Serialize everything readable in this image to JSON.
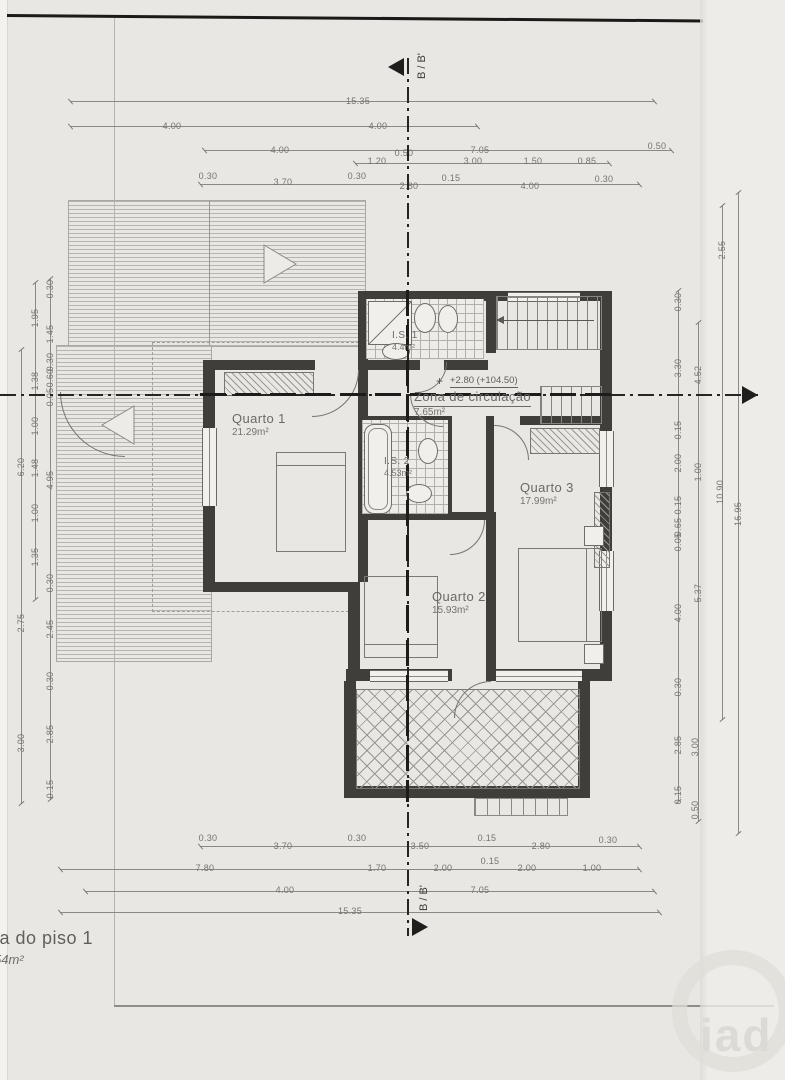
{
  "title": {
    "line1": "ta do piso 1",
    "line2": "54m²"
  },
  "watermark": "iad",
  "section_marks": {
    "top": "B / B'",
    "bottom": "B / B'"
  },
  "level_mark": {
    "icon": "+",
    "text": "+2.80 (+104.50)"
  },
  "rooms": {
    "quarto1": {
      "name": "Quarto 1",
      "area": "21.29m²"
    },
    "quarto2": {
      "name": "Quarto 2",
      "area": "15.93m²"
    },
    "quarto3": {
      "name": "Quarto 3",
      "area": "17.99m²"
    },
    "is1": {
      "name": "I.S. 1",
      "area": "4.4m²"
    },
    "is2": {
      "name": "I.S. 2",
      "area": "4.53m²"
    },
    "hall": {
      "name": "Zona de circulação",
      "area": "7.65m²"
    }
  },
  "dimensions": {
    "unit": "m",
    "lines": [
      [
        70,
        101,
        585,
        "h"
      ],
      [
        70,
        126,
        408,
        "h"
      ],
      [
        204,
        150,
        468,
        "h"
      ],
      [
        355,
        163,
        255,
        "h"
      ],
      [
        200,
        184,
        440,
        "h"
      ],
      [
        200,
        846,
        440,
        "h"
      ],
      [
        60,
        869,
        580,
        "h"
      ],
      [
        85,
        891,
        570,
        "h"
      ],
      [
        60,
        912,
        600,
        "h"
      ],
      [
        21,
        349,
        455,
        "v"
      ],
      [
        35,
        282,
        318,
        "v"
      ],
      [
        50,
        278,
        522,
        "v"
      ],
      [
        678,
        290,
        512,
        "v"
      ],
      [
        698,
        322,
        500,
        "v"
      ],
      [
        722,
        205,
        515,
        "v"
      ],
      [
        738,
        192,
        642,
        "v"
      ]
    ],
    "labels": [
      [
        "15.35",
        358,
        101
      ],
      [
        "4.00",
        172,
        126
      ],
      [
        "4.00",
        378,
        126
      ],
      [
        "4.00",
        280,
        150
      ],
      [
        "7.05",
        480,
        150
      ],
      [
        "0.50",
        657,
        146
      ],
      [
        "1.20",
        377,
        161
      ],
      [
        "0.50",
        404,
        153
      ],
      [
        "3.00",
        473,
        161
      ],
      [
        "1.50",
        533,
        161
      ],
      [
        "0.85",
        587,
        161
      ],
      [
        "0.30",
        208,
        176
      ],
      [
        "3.70",
        283,
        182
      ],
      [
        "0.30",
        357,
        176
      ],
      [
        "2.80",
        409,
        186
      ],
      [
        "0.15",
        451,
        178
      ],
      [
        "4.00",
        530,
        186
      ],
      [
        "0.30",
        604,
        179
      ],
      [
        "0.30",
        208,
        838
      ],
      [
        "3.70",
        283,
        846
      ],
      [
        "0.30",
        357,
        838
      ],
      [
        "3.50",
        420,
        846
      ],
      [
        "0.15",
        487,
        838
      ],
      [
        "2.80",
        541,
        846
      ],
      [
        "0.30",
        608,
        840
      ],
      [
        "7.80",
        205,
        868
      ],
      [
        "1.70",
        377,
        868
      ],
      [
        "2.00",
        443,
        868
      ],
      [
        "0.15",
        490,
        861
      ],
      [
        "2.00",
        527,
        868
      ],
      [
        "1.00",
        592,
        868
      ],
      [
        "4.00",
        285,
        890
      ],
      [
        "7.05",
        480,
        890
      ],
      [
        "15.35",
        350,
        911
      ],
      [
        "0.30",
        50,
        289,
        1
      ],
      [
        "1.95",
        35,
        318,
        1
      ],
      [
        "1.45",
        50,
        334,
        1
      ],
      [
        "0.30",
        50,
        362,
        1
      ],
      [
        "0.60",
        50,
        378,
        1
      ],
      [
        "1.38",
        35,
        381,
        1
      ],
      [
        "0.05",
        50,
        397,
        1
      ],
      [
        "1.00",
        35,
        426,
        1
      ],
      [
        "6.20",
        21,
        467,
        1
      ],
      [
        "1.48",
        35,
        468,
        1
      ],
      [
        "4.95",
        50,
        480,
        1
      ],
      [
        "1.00",
        35,
        513,
        1
      ],
      [
        "1.35",
        35,
        557,
        1
      ],
      [
        "0.30",
        50,
        583,
        1
      ],
      [
        "2.45",
        50,
        629,
        1
      ],
      [
        "2.75",
        21,
        623,
        1
      ],
      [
        "0.30",
        50,
        681,
        1
      ],
      [
        "2.85",
        50,
        734,
        1
      ],
      [
        "3.00",
        21,
        743,
        1
      ],
      [
        "0.15",
        50,
        789,
        1
      ],
      [
        "0.30",
        678,
        302,
        1
      ],
      [
        "3.30",
        678,
        368,
        1
      ],
      [
        "0.15",
        678,
        430,
        1
      ],
      [
        "2.00",
        678,
        463,
        1
      ],
      [
        "0.15",
        678,
        505,
        1
      ],
      [
        "0.65",
        678,
        527,
        1
      ],
      [
        "0.05",
        678,
        542,
        1
      ],
      [
        "4.00",
        678,
        613,
        1
      ],
      [
        "0.30",
        678,
        687,
        1
      ],
      [
        "2.85",
        678,
        745,
        1
      ],
      [
        "0.15",
        678,
        795,
        1
      ],
      [
        "4.52",
        698,
        375,
        1
      ],
      [
        "1.00",
        698,
        472,
        1
      ],
      [
        "5.37",
        698,
        593,
        1
      ],
      [
        "3.00",
        695,
        747,
        1
      ],
      [
        "0.50",
        695,
        810,
        1
      ],
      [
        "2.55",
        722,
        250,
        1
      ],
      [
        "10.90",
        720,
        492,
        1
      ],
      [
        "16.95",
        738,
        514,
        1
      ]
    ]
  }
}
